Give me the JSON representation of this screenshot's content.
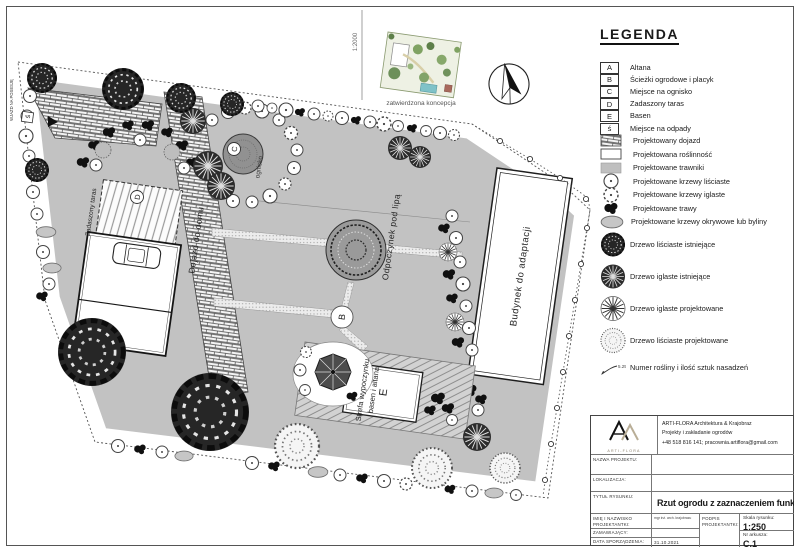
{
  "plan": {
    "labels": {
      "entrance": "WJAZD NA POSESJĘ",
      "driveway": "Dojazd do domu",
      "terrace": "Zadaszony taras",
      "firepit": "ognisko",
      "linden": "Odpoczynek pod lipą",
      "building": "Budynek do adaptacji",
      "zone1": "Strefa wypoczynku",
      "zone2": "basen i altana"
    },
    "badges": {
      "b": "B",
      "c": "C",
      "d": "D",
      "e": "E",
      "s": "ś"
    }
  },
  "inset": {
    "scale": "1:2000",
    "caption": "zatwierdzona koncepcja"
  },
  "legend": {
    "title": "LEGENDA",
    "letter_items": [
      {
        "letter": "A",
        "label": "Altana"
      },
      {
        "letter": "B",
        "label": "Ścieżki ogrodowe i placyk"
      },
      {
        "letter": "C",
        "label": "Miejsce na ognisko"
      },
      {
        "letter": "D",
        "label": "Zadaszony taras"
      },
      {
        "letter": "E",
        "label": "Basen"
      },
      {
        "letter": "ś",
        "label": "Miejsce na odpady"
      }
    ],
    "symbol_items": [
      {
        "icon": "brick-swatch",
        "label": "Projektowany dojazd"
      },
      {
        "icon": "white-swatch",
        "label": "Projektowana roślinność"
      },
      {
        "icon": "gray-swatch",
        "label": "Projektowane trawniki"
      },
      {
        "icon": "deciduous-shrub",
        "label": "Projektowane krzewy liściaste"
      },
      {
        "icon": "conifer-shrub",
        "label": "Projektowane krzewy iglaste"
      },
      {
        "icon": "grass-blob",
        "label": "Projektowane trawy"
      },
      {
        "icon": "groundcover-blob",
        "label": "Projektowane krzewy okrywowe lub byliny"
      },
      {
        "icon": "existing-deciduous-tree",
        "label": "Drzewo liściaste istniejące"
      },
      {
        "icon": "existing-conifer-tree",
        "label": "Drzewo iglaste istniejące"
      },
      {
        "icon": "proposed-conifer-tree",
        "label": "Drzewo iglaste projektowane"
      },
      {
        "icon": "proposed-deciduous-tree",
        "label": "Drzewo liściaste projektowane"
      },
      {
        "icon": "plant-number-arrow",
        "label": "Numer rośliny i ilość sztuk nasadzeń",
        "example": "5.25"
      }
    ]
  },
  "title_block": {
    "logo": {
      "name": "ARTI-FLORA"
    },
    "company_lines": [
      "ARTI-FLORA Architektura & Krajobraz",
      "Projekty i zakładanie ogrodów",
      "+48 518 816 141; pracownia.artiflora@gmail.com"
    ],
    "project_label": "NAZWA PROJEKTU:",
    "location_label": "LOKALIZACJA:",
    "title_label": "TYTUŁ RYSUNKU:",
    "drawing_title": "Rzut ogrodu z zaznaczeniem funkcji",
    "designer_label": "IMIĘ I NAZWISKO PROJEKTANTKI:",
    "designer_value": "mgr inż. arch. krajobrazu",
    "signature_label": "PODPIS PROJEKTANTKI:",
    "client_label": "ZAMAWIAJĄCY:",
    "date_label": "DATA SPORZĄDZENIA:",
    "date_value": "31.10.2021",
    "scale_label": "Skala rysunku:",
    "scale_value": "1:250",
    "sheet_label": "Nr arkusza:",
    "sheet_value": "C.1"
  },
  "colors": {
    "lawn": "#c2c2c2",
    "deck": "#d2d2d2",
    "pool_teal": "#7fc2c8"
  }
}
